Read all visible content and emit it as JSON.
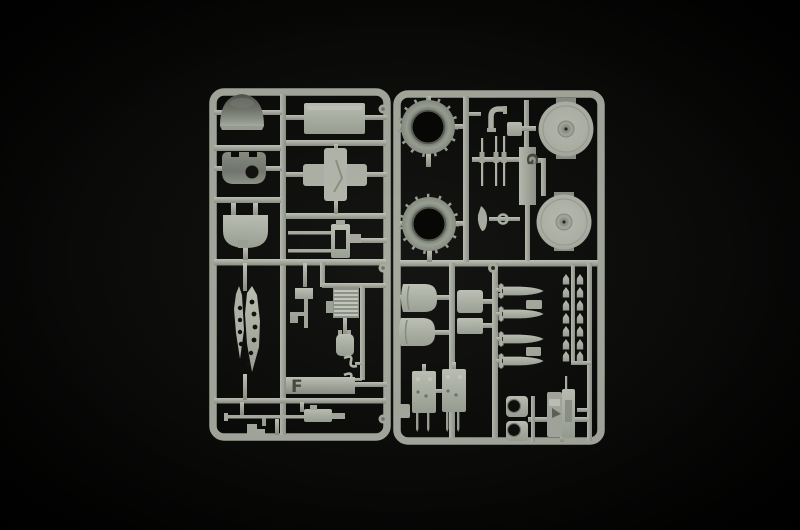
{
  "photo": {
    "subject": "Two grey injection-moulded plastic model kit sprues photographed on a black background",
    "background_color": "#000000",
    "plastic_color": "#aeb2a8",
    "shadow_color": "#7d827b"
  },
  "sprues": [
    {
      "label": "F",
      "parts": [
        "turret-dome",
        "dome-shell-with-hatch-hole",
        "rounded-shield",
        "stowage-box",
        "cross-shaped-mount",
        "gun-carriage-with-two-barrels",
        "perforated-gun-jacket-blades",
        "hanging-bracket",
        "radiator-grille",
        "strapped-canister",
        "s-hooks",
        "heavy-machine-gun",
        "stepped-bracket"
      ]
    },
    {
      "label": "G",
      "parts": [
        "toothed-cowling-ring",
        "toothed-cowling-ring",
        "road-wheel-disc",
        "road-wheel-disc",
        "exhaust-elbow",
        "junction-block",
        "machine-gun-barrels",
        "teardrop-fairing",
        "small-ring",
        "engine-cowling-half",
        "engine-cowling-half",
        "hatch-panel",
        "hatch-panel",
        "finned-bomb",
        "finned-bomb",
        "finned-bomb",
        "finned-bomb",
        "small-bomb-cluster",
        "pinned-mounting-plate",
        "pinned-mounting-plate",
        "wheel-hub",
        "wheel-hub",
        "twin-gun-mount",
        "side-panel"
      ]
    }
  ]
}
